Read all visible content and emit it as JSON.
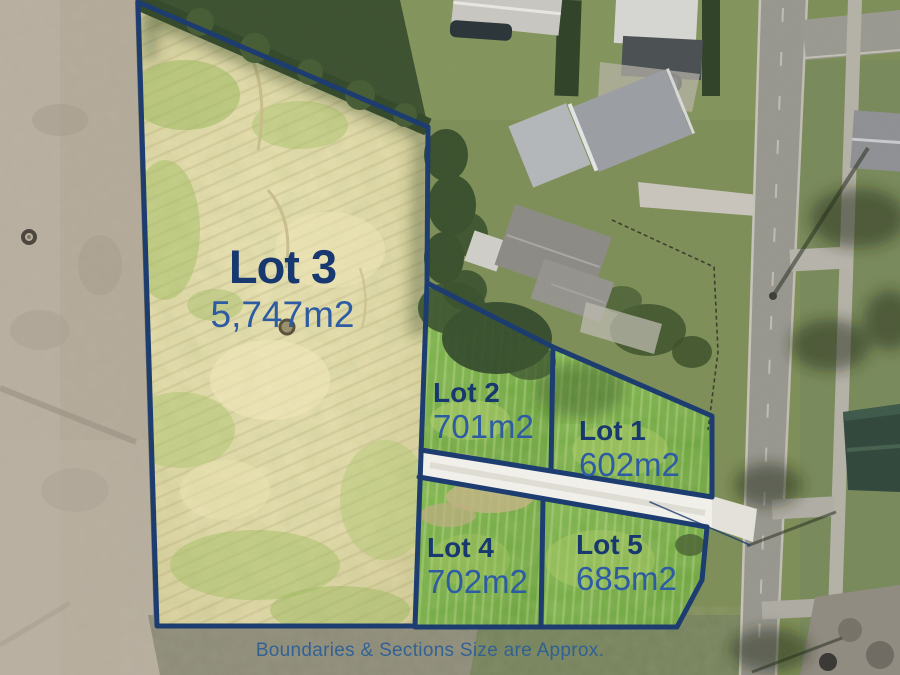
{
  "plan": {
    "caption": "Boundaries & Sections Size are Approx.",
    "lots": [
      {
        "id": "lot-1",
        "name": "Lot 1",
        "area": "602m2"
      },
      {
        "id": "lot-2",
        "name": "Lot 2",
        "area": "701m2"
      },
      {
        "id": "lot-3",
        "name": "Lot 3",
        "area": "5,747m2"
      },
      {
        "id": "lot-4",
        "name": "Lot 4",
        "area": "702m2"
      },
      {
        "id": "lot-5",
        "name": "Lot 5",
        "area": "685m2"
      }
    ]
  },
  "colors": {
    "boundary": "#1d3c70",
    "lot_title": "#17396f",
    "lot_area": "#2e5ca3",
    "caption": "#2d5f95",
    "subdivision_grass": "#72ab41",
    "dry_grass": "#e4daa9",
    "driveway": "#f2f1ec"
  }
}
